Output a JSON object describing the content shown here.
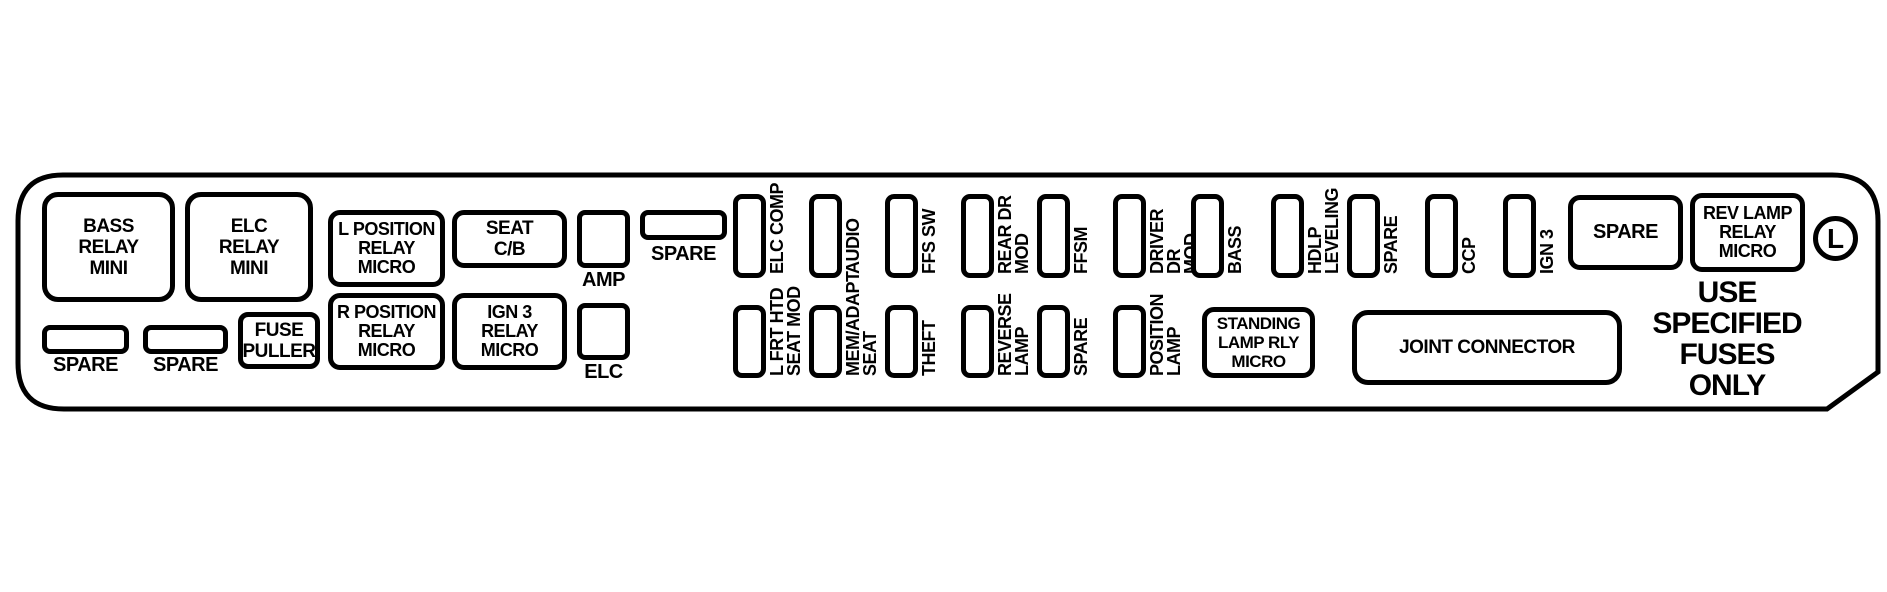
{
  "colors": {
    "line": "#000000",
    "background": "#ffffff"
  },
  "left_section": {
    "bass_relay_mini": "BASS\nRELAY\nMINI",
    "elc_relay_mini": "ELC\nRELAY\nMINI",
    "spare_1": "SPARE",
    "spare_2": "SPARE",
    "fuse_puller": "FUSE\nPULLER"
  },
  "mid_section": {
    "l_position_relay_micro": "L POSITION\nRELAY\nMICRO",
    "r_position_relay_micro": "R POSITION\nRELAY\nMICRO",
    "seat_cb": "SEAT\nC/B",
    "ign3_relay_micro": "IGN 3\nRELAY\nMICRO",
    "amp": "AMP",
    "elc": "ELC",
    "spare": "SPARE"
  },
  "top_fuse_row": [
    {
      "label": "ELC COMP"
    },
    {
      "label": "AUDIO"
    },
    {
      "label": "FFS SW"
    },
    {
      "label": "REAR DR\nMOD"
    },
    {
      "label": "FFSM"
    },
    {
      "label": "DRIVER DR\nMOD"
    },
    {
      "label": "BASS"
    },
    {
      "label": "HDLP\nLEVELING"
    },
    {
      "label": "SPARE"
    },
    {
      "label": "CCP"
    },
    {
      "label": "IGN 3"
    }
  ],
  "bottom_fuse_row": [
    {
      "label": "L FRT HTD\nSEAT MOD"
    },
    {
      "label": "MEM/ADAPT\nSEAT"
    },
    {
      "label": "THEFT"
    },
    {
      "label": "REVERSE\nLAMP"
    },
    {
      "label": "SPARE"
    },
    {
      "label": "POSITION\nLAMP"
    }
  ],
  "right_section": {
    "spare": "SPARE",
    "rev_lamp_relay_micro": "REV LAMP\nRELAY\nMICRO",
    "circled_letter": "L",
    "standing_lamp_relay_micro": "STANDING\nLAMP RLY\nMICRO",
    "joint_connector": "JOINT CONNECTOR",
    "warning": "USE\nSPECIFIED\nFUSES\nONLY"
  }
}
